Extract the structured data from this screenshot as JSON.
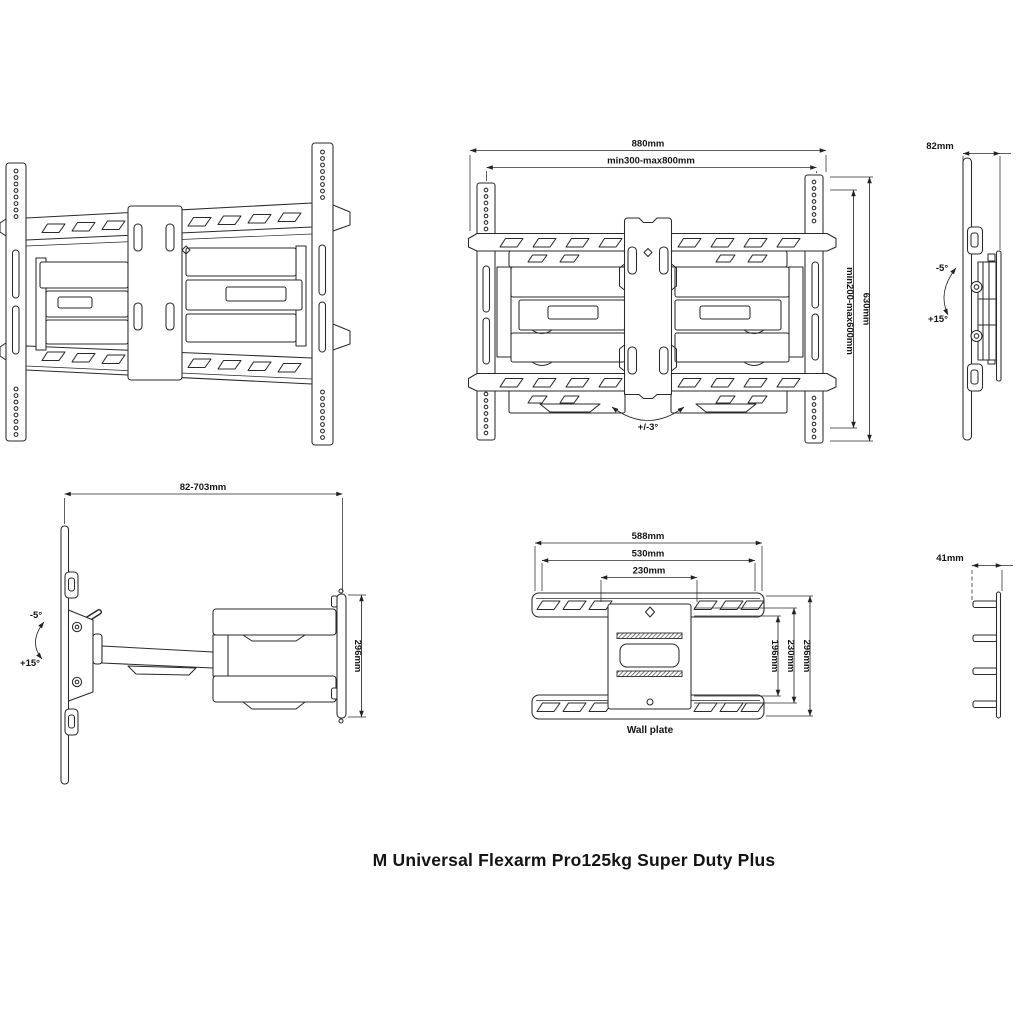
{
  "title": "M Universal Flexarm Pro125kg Super Duty Plus",
  "colors": {
    "line": "#2a2a2a",
    "background": "#ffffff",
    "text": "#141414"
  },
  "views": {
    "front": {
      "width_total": "880mm",
      "vesa_width_range": "min300-max800mm",
      "height_total": "630mm",
      "vesa_height_range": "min200-max600mm",
      "swivel_range": "+/-3°"
    },
    "side_folded": {
      "depth": "82mm",
      "tilt_up": "-5°",
      "tilt_down": "+15°"
    },
    "side_extended": {
      "wall_distance_range": "82-703mm",
      "tilt_up": "-5°",
      "tilt_down": "+15°",
      "bracket_height": "296mm"
    },
    "wall_plate": {
      "label": "Wall plate",
      "width_total": "588mm",
      "hole_spacing_width": "530mm",
      "center_width": "230mm",
      "inner_height": "196mm",
      "hole_spacing_height": "230mm",
      "height_total": "296mm"
    },
    "wall_plate_side": {
      "depth": "41mm"
    }
  }
}
